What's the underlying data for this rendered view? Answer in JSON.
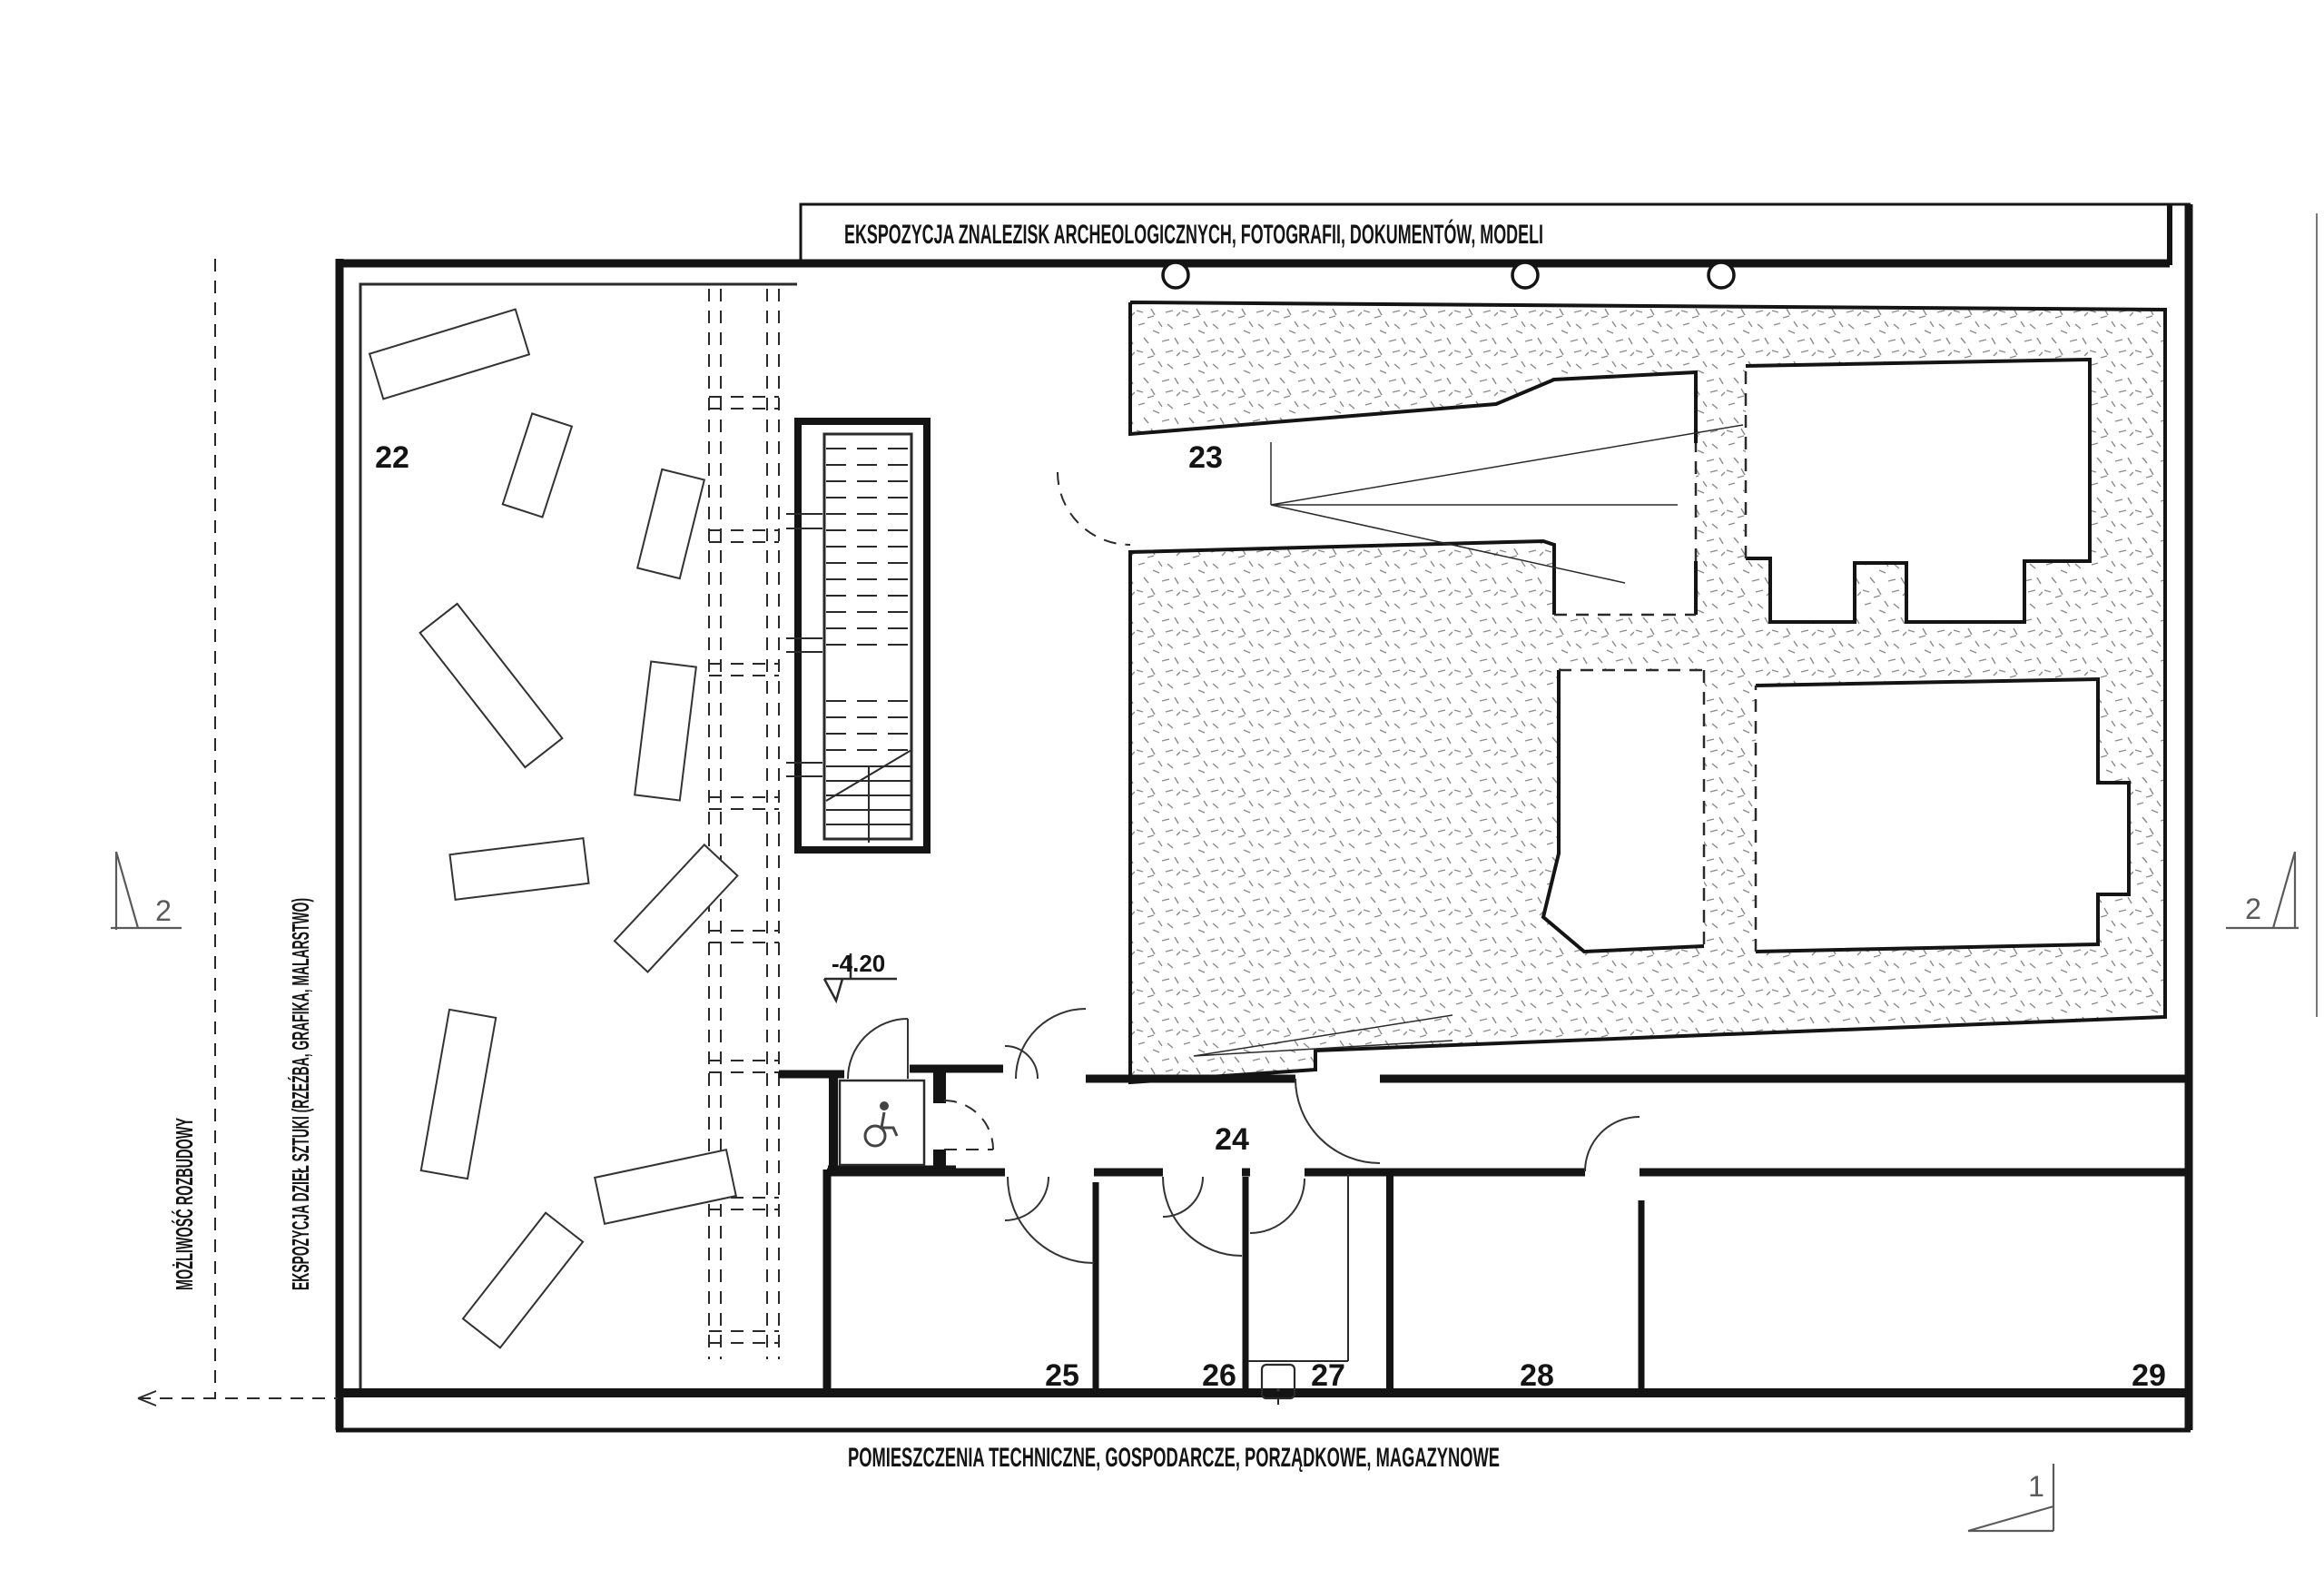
{
  "canvas": {
    "background": "#ffffff",
    "line_color": "#141414",
    "stipple_color": "#8a8a8a",
    "marker_color": "#5a5a5a"
  },
  "labels": {
    "top_band": "EKSPOZYCJA ZNALEZISK ARCHEOLOGICZNYCH, FOTOGRAFII, DOKUMENTÓW, MODELI",
    "bottom_band": "POMIESZCZENIA TECHNICZNE, GOSPODARCZE, PORZĄDKOWE, MAGAZYNOWE",
    "left_expansion": "MOŻLIWOŚĆ ROZBUDOWY",
    "left_art": "EKSPOZYCJA DZIEŁ SZTUKI (RZEŹBA, GRAFIKA, MALARSTWO)",
    "elevation": "-4.20"
  },
  "rooms": {
    "r22": "22",
    "r23": "23",
    "r24": "24",
    "r25": "25",
    "r26": "26",
    "r27": "27",
    "r28": "28",
    "r29": "29"
  },
  "section_markers": {
    "left": "2",
    "right": "2",
    "bottom": "1"
  },
  "icons": {
    "wheelchair": "wheelchair-icon"
  }
}
